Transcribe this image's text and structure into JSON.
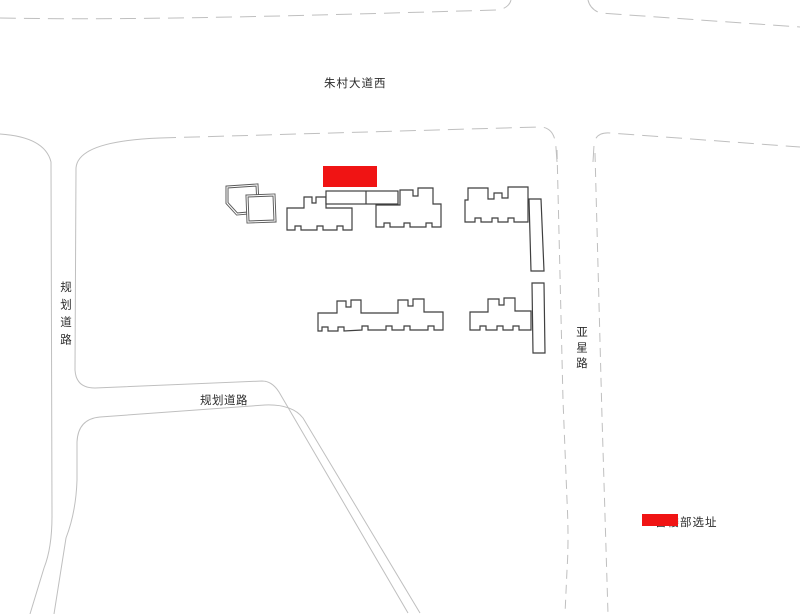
{
  "roads": {
    "top": "朱村大道西",
    "left": "规划道路",
    "middle": "规划道路",
    "right": "亚星路"
  },
  "site_marker": {
    "color": "#f01414"
  },
  "legend": {
    "swatch_color": "#f01414",
    "label": "售楼部选址"
  }
}
